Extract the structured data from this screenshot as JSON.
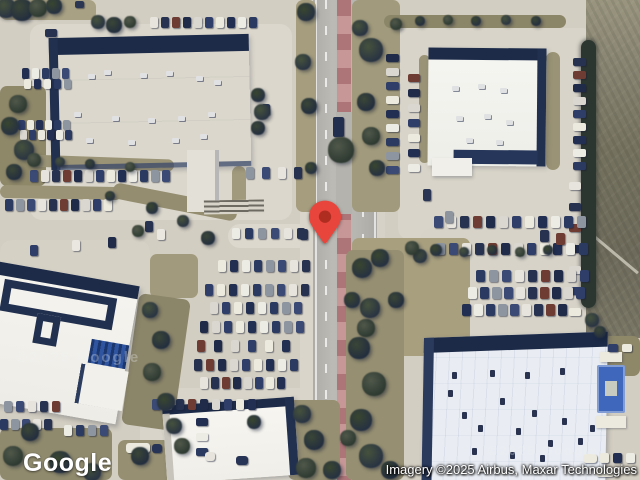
{
  "app": {
    "type": "satellite-map-view"
  },
  "branding": {
    "logo_text": "Google"
  },
  "attribution": {
    "text": "Imagery ©2025 Airbus, Maxar Technologies"
  },
  "watermarks": [
    {
      "text": "©2025 Google",
      "x": 16,
      "y": 349,
      "size": 15,
      "opacity": 0.3
    },
    {
      "text": "©2025 Google",
      "x": 488,
      "y": 443,
      "size": 13,
      "opacity": 0.3
    }
  ],
  "pin": {
    "name": "location-pin",
    "tip_x": 325,
    "tip_y": 244,
    "color": "#E8453C",
    "dot_color": "#8C1D12"
  },
  "palette": {
    "concrete": "#d3cec2",
    "road": "#b5b3ad",
    "median": "#bd8a8c",
    "roof_white": "#f5f4ef",
    "roof_blue": "#e9edf3",
    "roof_shadow": "#1d2b49",
    "grass": "#a29a7c",
    "tree_dark": "#2c3830",
    "field": "#75725f",
    "car_colors": [
      "#26324f",
      "#ecebe4",
      "#1f2b49",
      "#8d95a0",
      "#2e3e68",
      "#e6e4dc",
      "#232f52",
      "#6e3c32",
      "#2a3a60",
      "#d9d7cf",
      "#3a4a74",
      "#eceade"
    ]
  },
  "scene": {
    "aprons": [
      [
        30,
        24,
        262,
        196,
        "#dbd7cc"
      ],
      [
        398,
        28,
        196,
        212,
        "#d8d4c9"
      ],
      [
        140,
        388,
        182,
        92,
        "#d8d4c9"
      ],
      [
        420,
        228,
        188,
        112,
        "#d7d3c8"
      ],
      [
        0,
        240,
        150,
        170,
        "#d5d1c5"
      ],
      [
        228,
        224,
        88,
        24,
        "#dcd8cd"
      ],
      [
        358,
        238,
        74,
        26,
        "#dad6cb"
      ]
    ],
    "grass": [
      [
        0,
        0,
        96,
        20,
        "#a9a183",
        0
      ],
      [
        0,
        86,
        46,
        100,
        "#8e8768",
        0
      ],
      [
        296,
        0,
        20,
        212,
        "#a59d7e",
        0
      ],
      [
        352,
        0,
        48,
        212,
        "#a19a7c",
        0
      ],
      [
        384,
        15,
        182,
        13,
        "#8c8668",
        0
      ],
      [
        352,
        238,
        118,
        118,
        "#a89f7e",
        0
      ],
      [
        346,
        250,
        58,
        230,
        "#968f72",
        0
      ],
      [
        26,
        157,
        148,
        12,
        "#9a9375",
        2
      ],
      [
        0,
        186,
        122,
        13,
        "#9a9375",
        1
      ],
      [
        112,
        194,
        126,
        16,
        "#948d70",
        11
      ],
      [
        150,
        254,
        48,
        44,
        "#a29a7c",
        0
      ],
      [
        130,
        296,
        52,
        132,
        "#8b8569",
        8
      ],
      [
        288,
        400,
        52,
        80,
        "#968f72",
        0
      ],
      [
        546,
        52,
        14,
        118,
        "#9a9375",
        0
      ],
      [
        419,
        55,
        11,
        108,
        "#9a9375",
        0
      ],
      [
        586,
        336,
        54,
        40,
        "#8e8768",
        0
      ],
      [
        0,
        428,
        112,
        52,
        "#8f8a6d",
        0
      ],
      [
        118,
        440,
        72,
        40,
        "#968f72",
        0
      ],
      [
        232,
        166,
        14,
        44,
        "#a29a7c",
        0
      ]
    ],
    "trees": [
      [
        6,
        8,
        10
      ],
      [
        22,
        10,
        11
      ],
      [
        38,
        8,
        9
      ],
      [
        54,
        6,
        8
      ],
      [
        98,
        22,
        7
      ],
      [
        114,
        25,
        8
      ],
      [
        130,
        22,
        6
      ],
      [
        258,
        95,
        7
      ],
      [
        262,
        112,
        8
      ],
      [
        258,
        128,
        7
      ],
      [
        18,
        104,
        9
      ],
      [
        10,
        126,
        9
      ],
      [
        24,
        150,
        10
      ],
      [
        14,
        172,
        8
      ],
      [
        34,
        160,
        7
      ],
      [
        306,
        12,
        9
      ],
      [
        303,
        62,
        8
      ],
      [
        309,
        106,
        8
      ],
      [
        341,
        150,
        13
      ],
      [
        311,
        168,
        6
      ],
      [
        371,
        50,
        12
      ],
      [
        366,
        102,
        9
      ],
      [
        371,
        136,
        9
      ],
      [
        377,
        168,
        8
      ],
      [
        360,
        28,
        8
      ],
      [
        420,
        21,
        5
      ],
      [
        448,
        20,
        5
      ],
      [
        476,
        21,
        5
      ],
      [
        506,
        20,
        5
      ],
      [
        536,
        21,
        5
      ],
      [
        396,
        24,
        6
      ],
      [
        380,
        258,
        9
      ],
      [
        420,
        256,
        7
      ],
      [
        396,
        300,
        8
      ],
      [
        366,
        328,
        9
      ],
      [
        362,
        268,
        10
      ],
      [
        370,
        308,
        10
      ],
      [
        359,
        348,
        11
      ],
      [
        374,
        384,
        12
      ],
      [
        361,
        420,
        11
      ],
      [
        371,
        456,
        12
      ],
      [
        390,
        470,
        9
      ],
      [
        348,
        438,
        8
      ],
      [
        352,
        300,
        8
      ],
      [
        60,
        162,
        5
      ],
      [
        90,
        164,
        5
      ],
      [
        130,
        167,
        5
      ],
      [
        152,
        208,
        6
      ],
      [
        183,
        221,
        6
      ],
      [
        208,
        238,
        7
      ],
      [
        138,
        231,
        6
      ],
      [
        110,
        196,
        5
      ],
      [
        150,
        310,
        8
      ],
      [
        161,
        340,
        9
      ],
      [
        152,
        372,
        9
      ],
      [
        166,
        402,
        9
      ],
      [
        174,
        426,
        8
      ],
      [
        30,
        432,
        9
      ],
      [
        13,
        456,
        10
      ],
      [
        60,
        462,
        11
      ],
      [
        92,
        472,
        9
      ],
      [
        140,
        456,
        9
      ],
      [
        182,
        446,
        8
      ],
      [
        254,
        422,
        7
      ],
      [
        302,
        414,
        9
      ],
      [
        314,
        440,
        10
      ],
      [
        306,
        468,
        10
      ],
      [
        332,
        470,
        9
      ],
      [
        592,
        320,
        7
      ],
      [
        600,
        332,
        6
      ],
      [
        412,
        248,
        7
      ],
      [
        436,
        250,
        6
      ],
      [
        464,
        252,
        5
      ],
      [
        492,
        250,
        5
      ],
      [
        520,
        252,
        5
      ],
      [
        548,
        250,
        5
      ]
    ],
    "car_rows": [
      {
        "x": 150,
        "y": 17,
        "n": 10,
        "dx": 11,
        "dy": 0,
        "w": 8,
        "h": 11,
        "s": 1
      },
      {
        "x": 30,
        "y": 170,
        "n": 13,
        "dx": 11,
        "dy": 0,
        "w": 8,
        "h": 12,
        "s": 2
      },
      {
        "x": 246,
        "y": 167,
        "n": 4,
        "dx": 16,
        "dy": 0,
        "w": 8,
        "h": 12,
        "s": 3
      },
      {
        "x": 5,
        "y": 199,
        "n": 10,
        "dx": 11,
        "dy": 0,
        "w": 8,
        "h": 12,
        "s": 4
      },
      {
        "x": 232,
        "y": 228,
        "n": 6,
        "dx": 13,
        "dy": 0,
        "w": 8,
        "h": 11,
        "s": 5
      },
      {
        "x": 22,
        "y": 68,
        "n": 5,
        "dx": 10,
        "dy": 0,
        "w": 7,
        "h": 11,
        "s": 6
      },
      {
        "x": 24,
        "y": 79,
        "n": 5,
        "dx": 10,
        "dy": 0,
        "w": 7,
        "h": 10,
        "s": 7
      },
      {
        "x": 18,
        "y": 120,
        "n": 6,
        "dx": 9,
        "dy": 0,
        "w": 7,
        "h": 10,
        "s": 8
      },
      {
        "x": 20,
        "y": 130,
        "n": 6,
        "dx": 9,
        "dy": 0,
        "w": 7,
        "h": 10,
        "s": 9
      },
      {
        "x": 386,
        "y": 54,
        "n": 9,
        "dx": 0,
        "dy": 14,
        "w": 13,
        "h": 8,
        "s": 10
      },
      {
        "x": 408,
        "y": 74,
        "n": 7,
        "dx": 0,
        "dy": 15,
        "w": 12,
        "h": 8,
        "s": 11
      },
      {
        "x": 573,
        "y": 58,
        "n": 9,
        "dx": 0,
        "dy": 13,
        "w": 13,
        "h": 8,
        "s": 12
      },
      {
        "x": 569,
        "y": 182,
        "n": 7,
        "dx": 0,
        "dy": 21,
        "w": 12,
        "h": 8,
        "s": 13
      },
      {
        "x": 434,
        "y": 216,
        "n": 12,
        "dx": 13,
        "dy": 0,
        "w": 9,
        "h": 12,
        "s": 14
      },
      {
        "x": 436,
        "y": 243,
        "n": 12,
        "dx": 13,
        "dy": 0,
        "w": 9,
        "h": 12,
        "s": 15
      },
      {
        "x": 476,
        "y": 270,
        "n": 9,
        "dx": 13,
        "dy": 0,
        "w": 9,
        "h": 12,
        "s": 16
      },
      {
        "x": 468,
        "y": 287,
        "n": 10,
        "dx": 12,
        "dy": 0,
        "w": 9,
        "h": 12,
        "s": 17
      },
      {
        "x": 462,
        "y": 304,
        "n": 9,
        "dx": 12,
        "dy": 0,
        "w": 9,
        "h": 12,
        "s": 18
      },
      {
        "x": 218,
        "y": 260,
        "n": 8,
        "dx": 12,
        "dy": 0,
        "w": 8,
        "h": 12,
        "s": 19
      },
      {
        "x": 205,
        "y": 284,
        "n": 9,
        "dx": 12,
        "dy": 0,
        "w": 8,
        "h": 12,
        "s": 20
      },
      {
        "x": 210,
        "y": 302,
        "n": 8,
        "dx": 12,
        "dy": 0,
        "w": 8,
        "h": 12,
        "s": 21
      },
      {
        "x": 200,
        "y": 321,
        "n": 9,
        "dx": 12,
        "dy": 0,
        "w": 8,
        "h": 12,
        "s": 22
      },
      {
        "x": 197,
        "y": 340,
        "n": 6,
        "dx": 17,
        "dy": 0,
        "w": 8,
        "h": 12,
        "s": 23
      },
      {
        "x": 194,
        "y": 359,
        "n": 9,
        "dx": 12,
        "dy": 0,
        "w": 8,
        "h": 12,
        "s": 24
      },
      {
        "x": 200,
        "y": 377,
        "n": 8,
        "dx": 11,
        "dy": 0,
        "w": 8,
        "h": 12,
        "s": 25
      },
      {
        "x": 152,
        "y": 399,
        "n": 9,
        "dx": 12,
        "dy": 0,
        "w": 8,
        "h": 11,
        "s": 26
      },
      {
        "x": 4,
        "y": 401,
        "n": 5,
        "dx": 12,
        "dy": 0,
        "w": 8,
        "h": 11,
        "s": 27
      },
      {
        "x": 0,
        "y": 419,
        "n": 5,
        "dx": 11,
        "dy": 0,
        "w": 8,
        "h": 11,
        "s": 28
      },
      {
        "x": 64,
        "y": 425,
        "n": 4,
        "dx": 12,
        "dy": 0,
        "w": 8,
        "h": 11,
        "s": 29
      },
      {
        "x": 196,
        "y": 418,
        "n": 3,
        "dx": 0,
        "dy": 15,
        "w": 12,
        "h": 8,
        "s": 30
      },
      {
        "x": 600,
        "y": 453,
        "n": 3,
        "dx": 13,
        "dy": 0,
        "w": 9,
        "h": 10,
        "s": 31
      },
      {
        "x": 608,
        "y": 344,
        "n": 2,
        "dx": 14,
        "dy": 0,
        "w": 10,
        "h": 8,
        "s": 32
      }
    ],
    "cars": [
      {
        "x": 45,
        "y": 29,
        "w": 12,
        "h": 8,
        "c": "#26324f"
      },
      {
        "x": 75,
        "y": 1,
        "w": 9,
        "h": 7,
        "c": "#2b3752"
      },
      {
        "x": 333,
        "y": 117,
        "w": 11,
        "h": 20,
        "c": "#232f4e"
      },
      {
        "x": 145,
        "y": 221,
        "w": 8,
        "h": 11,
        "c": "#26324f"
      },
      {
        "x": 157,
        "y": 229,
        "w": 8,
        "h": 11,
        "c": "#e9e7e0"
      },
      {
        "x": 108,
        "y": 237,
        "w": 8,
        "h": 11,
        "c": "#1f2b49"
      },
      {
        "x": 72,
        "y": 240,
        "w": 8,
        "h": 11,
        "c": "#e9e7e0"
      },
      {
        "x": 30,
        "y": 245,
        "w": 8,
        "h": 11,
        "c": "#2e3e68"
      },
      {
        "x": 300,
        "y": 229,
        "w": 8,
        "h": 11,
        "c": "#26324f"
      },
      {
        "x": 423,
        "y": 189,
        "w": 8,
        "h": 12,
        "c": "#2a3654"
      },
      {
        "x": 445,
        "y": 211,
        "w": 8,
        "h": 12,
        "c": "#8d949e"
      },
      {
        "x": 262,
        "y": 104,
        "w": 8,
        "h": 11,
        "c": "#2a3654"
      },
      {
        "x": 556,
        "y": 233,
        "w": 9,
        "h": 12,
        "c": "#6e3c32"
      },
      {
        "x": 540,
        "y": 230,
        "w": 9,
        "h": 12,
        "c": "#26324f"
      }
    ],
    "vans": [
      {
        "x": 126,
        "y": 443,
        "w": 24,
        "h": 10,
        "c": "#eceade"
      },
      {
        "x": 152,
        "y": 444,
        "w": 10,
        "h": 9,
        "c": "#273455"
      },
      {
        "x": 583,
        "y": 454,
        "w": 14,
        "h": 9,
        "c": "#eceade"
      },
      {
        "x": 596,
        "y": 468,
        "w": 18,
        "h": 9,
        "c": "#eceade"
      },
      {
        "x": 236,
        "y": 456,
        "w": 12,
        "h": 9,
        "c": "#273455"
      },
      {
        "x": 205,
        "y": 452,
        "w": 10,
        "h": 9,
        "c": "#e6e4dc"
      }
    ],
    "rtus": [
      {
        "x": 88,
        "y": 74,
        "t": "light"
      },
      {
        "x": 104,
        "y": 70,
        "t": "light"
      },
      {
        "x": 140,
        "y": 73,
        "t": "light"
      },
      {
        "x": 166,
        "y": 71,
        "t": "light"
      },
      {
        "x": 196,
        "y": 76,
        "t": "light"
      },
      {
        "x": 214,
        "y": 80,
        "t": "light"
      },
      {
        "x": 74,
        "y": 112,
        "t": "light"
      },
      {
        "x": 112,
        "y": 116,
        "t": "light"
      },
      {
        "x": 148,
        "y": 118,
        "t": "light"
      },
      {
        "x": 178,
        "y": 116,
        "t": "light"
      },
      {
        "x": 208,
        "y": 112,
        "t": "light"
      },
      {
        "x": 86,
        "y": 138,
        "t": "light"
      },
      {
        "x": 128,
        "y": 140,
        "t": "light"
      },
      {
        "x": 172,
        "y": 138,
        "t": "light"
      },
      {
        "x": 200,
        "y": 134,
        "t": "light"
      },
      {
        "x": 452,
        "y": 86,
        "t": "light"
      },
      {
        "x": 478,
        "y": 84,
        "t": "light"
      },
      {
        "x": 500,
        "y": 88,
        "t": "light"
      },
      {
        "x": 456,
        "y": 116,
        "t": "light"
      },
      {
        "x": 484,
        "y": 114,
        "t": "light"
      },
      {
        "x": 506,
        "y": 120,
        "t": "light"
      },
      {
        "x": 466,
        "y": 138,
        "t": "light"
      },
      {
        "x": 496,
        "y": 140,
        "t": "light"
      },
      {
        "x": 448,
        "y": 390,
        "t": "dark"
      },
      {
        "x": 462,
        "y": 412,
        "t": "dark"
      },
      {
        "x": 478,
        "y": 425,
        "t": "dark"
      },
      {
        "x": 500,
        "y": 398,
        "t": "dark"
      },
      {
        "x": 516,
        "y": 428,
        "t": "dark"
      },
      {
        "x": 532,
        "y": 410,
        "t": "dark"
      },
      {
        "x": 548,
        "y": 440,
        "t": "dark"
      },
      {
        "x": 562,
        "y": 418,
        "t": "dark"
      },
      {
        "x": 578,
        "y": 438,
        "t": "dark"
      },
      {
        "x": 590,
        "y": 425,
        "t": "dark"
      },
      {
        "x": 472,
        "y": 448,
        "t": "dark"
      },
      {
        "x": 510,
        "y": 452,
        "t": "dark"
      },
      {
        "x": 540,
        "y": 455,
        "t": "dark"
      },
      {
        "x": 452,
        "y": 372,
        "t": "dark"
      },
      {
        "x": 490,
        "y": 370,
        "t": "dark"
      },
      {
        "x": 525,
        "y": 372,
        "t": "dark"
      },
      {
        "x": 560,
        "y": 368,
        "t": "dark"
      }
    ]
  }
}
